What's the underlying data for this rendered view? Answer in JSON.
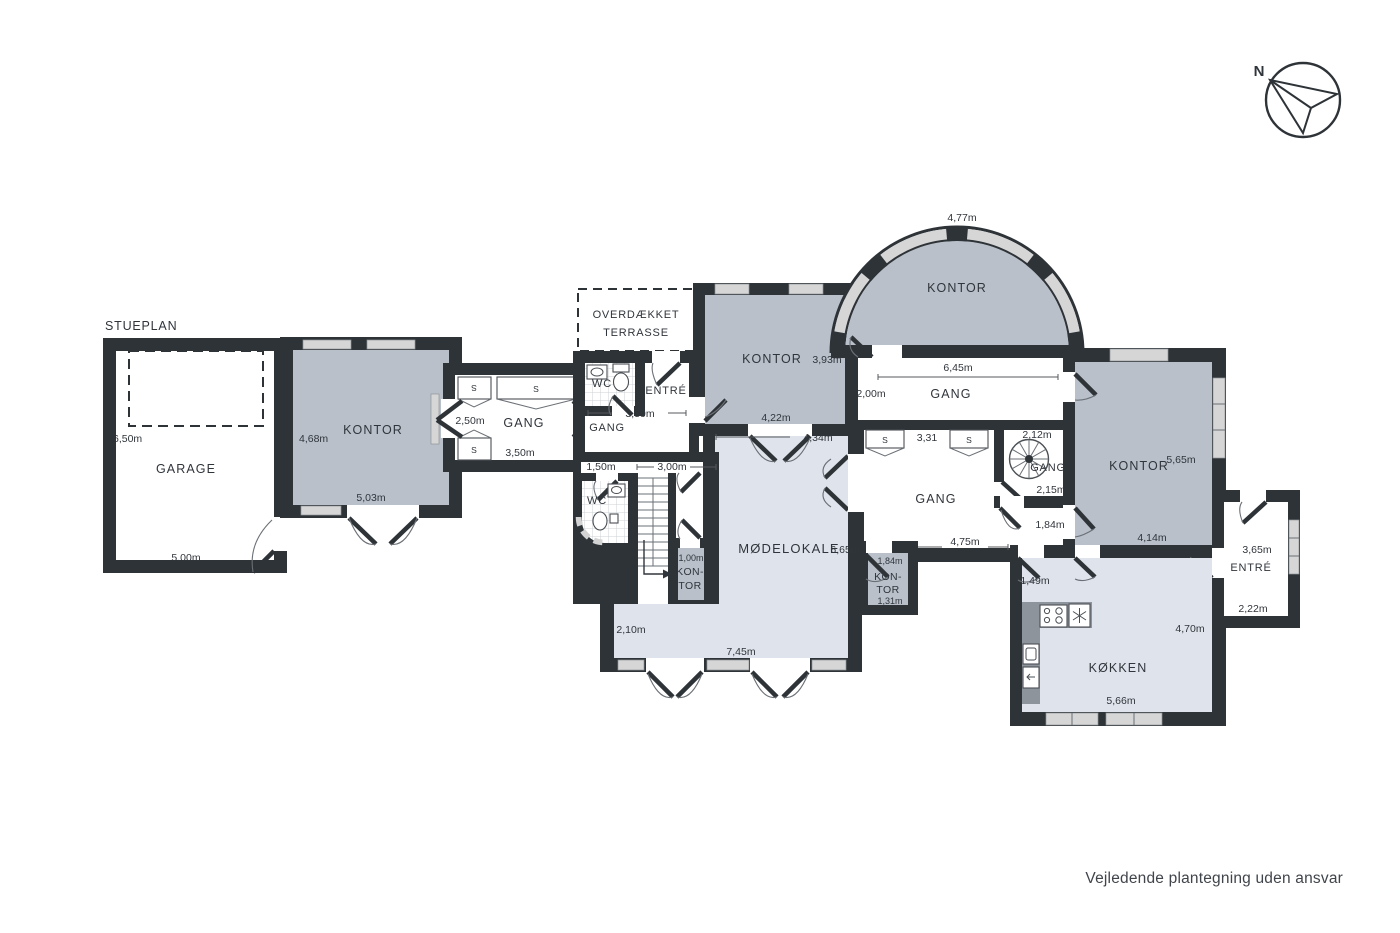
{
  "title": "STUEPLAN",
  "disclaimer": "Vejledende plantegning uden ansvar",
  "compass": {
    "north": "N"
  },
  "closet_label": "S",
  "rooms": {
    "garage": {
      "name": "GARAGE",
      "dim_height": "6,50m",
      "dim_width": "5,00m"
    },
    "kontor_vest": {
      "name": "KONTOR",
      "dim_height": "4,68m",
      "dim_width": "5,03m"
    },
    "gang_vest": {
      "name": "GANG",
      "dim_height": "2,50m",
      "dim_width": "3,50m"
    },
    "terrasse": {
      "line1": "OVERDÆKKET",
      "line2": "TERRASSE"
    },
    "wc_nord": {
      "name": "WC"
    },
    "entre_nord": {
      "name": "ENTRÉ"
    },
    "gang_nord_vest": {
      "name": "GANG",
      "dim_width": "3,39m"
    },
    "wc_syd": {
      "name": "WC",
      "dim_width": "1,50m"
    },
    "trappe": {
      "dim_width": "3,00m"
    },
    "kontor_lille_vest": {
      "dim_width": "1,00m",
      "name_line1": "KON-",
      "name_line2": "TOR"
    },
    "kontor_nord": {
      "name": "KONTOR",
      "dim_height": "3,93m",
      "dim_width": "4,22m"
    },
    "kontor_runde": {
      "name": "KONTOR",
      "dim_arc": "4,77m"
    },
    "gang_nord": {
      "name": "GANG",
      "dim_width": "6,45m",
      "dim_height": "2,00m"
    },
    "modelokale": {
      "name": "MØDELOKALE",
      "dim_height": "6,65m",
      "dim_top": "4,34m",
      "dim_width": "7,45m",
      "dim_left": "2,10m"
    },
    "gang_central": {
      "name": "GANG",
      "dim_top": "3,31",
      "dim_width": "4,75m"
    },
    "gang_spiral": {
      "name": "GANG",
      "dim_top": "2,12m",
      "dim_bottom": "2,15m",
      "dim_door": "1,84m"
    },
    "kontor_ost": {
      "name": "KONTOR",
      "dim_height": "5,65m",
      "dim_width": "4,14m"
    },
    "kontor_lille_ost": {
      "dim_top": "1,84m",
      "name_line1": "KON-",
      "name_line2": "TOR",
      "dim_bottom": "1,31m"
    },
    "entre_ost": {
      "name": "ENTRÉ",
      "dim_top": "3,65m",
      "dim_width": "2,22m"
    },
    "kokken": {
      "name": "KØKKEN",
      "dim_top": "1,49m",
      "dim_height": "4,70m",
      "dim_width": "5,66m"
    }
  }
}
